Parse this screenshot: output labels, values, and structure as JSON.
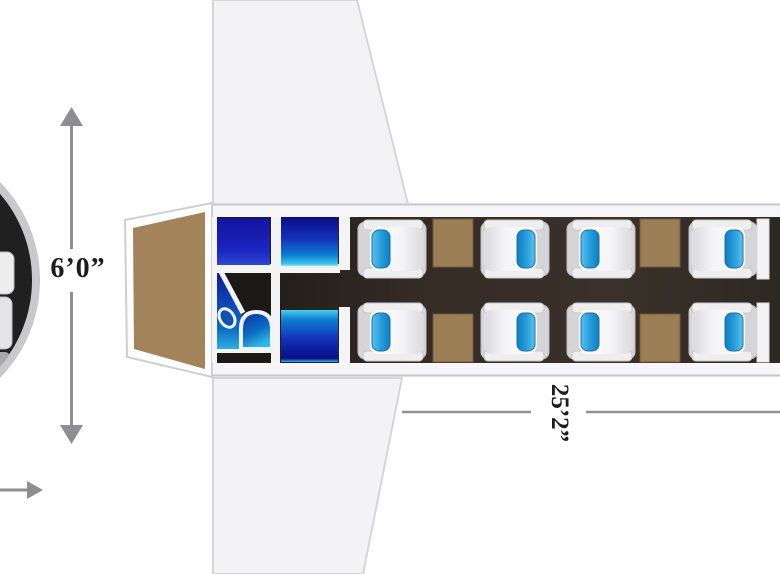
{
  "diagram": {
    "type": "aircraft-cabin-floorplan",
    "labels": {
      "cabin_height": "6’0”",
      "cabin_length": "25’2”"
    },
    "cabin": {
      "seat_count": 8,
      "club_tables": 4,
      "galley_units": 3,
      "lavatory": {
        "toilet": true,
        "sink": true
      },
      "wings": 2
    },
    "colors": {
      "seat_accent_blue": "#2aa0dd",
      "galley_blue": "#1233bb",
      "table_tan": "#9c7e54",
      "table_edge": "#6f5939",
      "nose_tan": "#a38359",
      "floor_dark": "#332b24",
      "wing_gray": "#f3f3f5",
      "wall_white": "#f5f5f6",
      "dimension_gray": "#8e8e90",
      "text_dark": "#1d1d1d"
    }
  }
}
